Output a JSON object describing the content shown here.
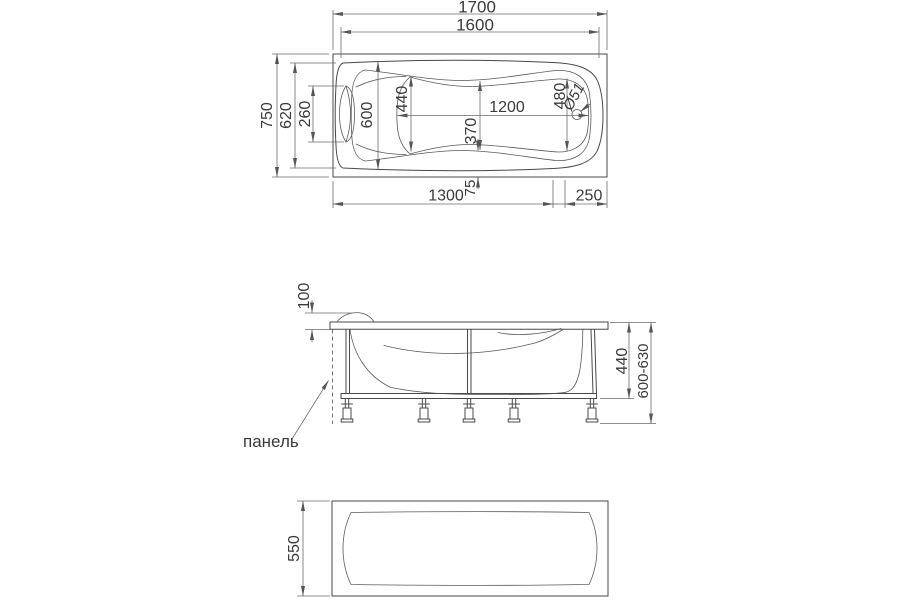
{
  "app": {
    "background": "#ffffff",
    "type_note": "bathtub technical dimension drawing"
  },
  "colors": {
    "object_line": "#4a4a4a",
    "dim_line": "#6b6b6b",
    "text": "#3a3a3a"
  },
  "top_view": {
    "overall_length": "1700",
    "rim_length": "1600",
    "overall_width": "750",
    "rim_width": "620",
    "headrest_width": "260",
    "inner_width_head": "600",
    "basin_width_head": "440",
    "basin_length": "1200",
    "basin_width_mid": "370",
    "basin_width_foot": "480",
    "drain_diameter": "Ø51",
    "bottom_span_main": "1300",
    "bottom_span_small": "75",
    "bottom_span_end": "250"
  },
  "side_view": {
    "rim_drop": "100",
    "frame_height": "440",
    "adjustable_height": "600-630",
    "panel_label": "панель"
  },
  "front_view": {
    "panel_height": "550"
  }
}
